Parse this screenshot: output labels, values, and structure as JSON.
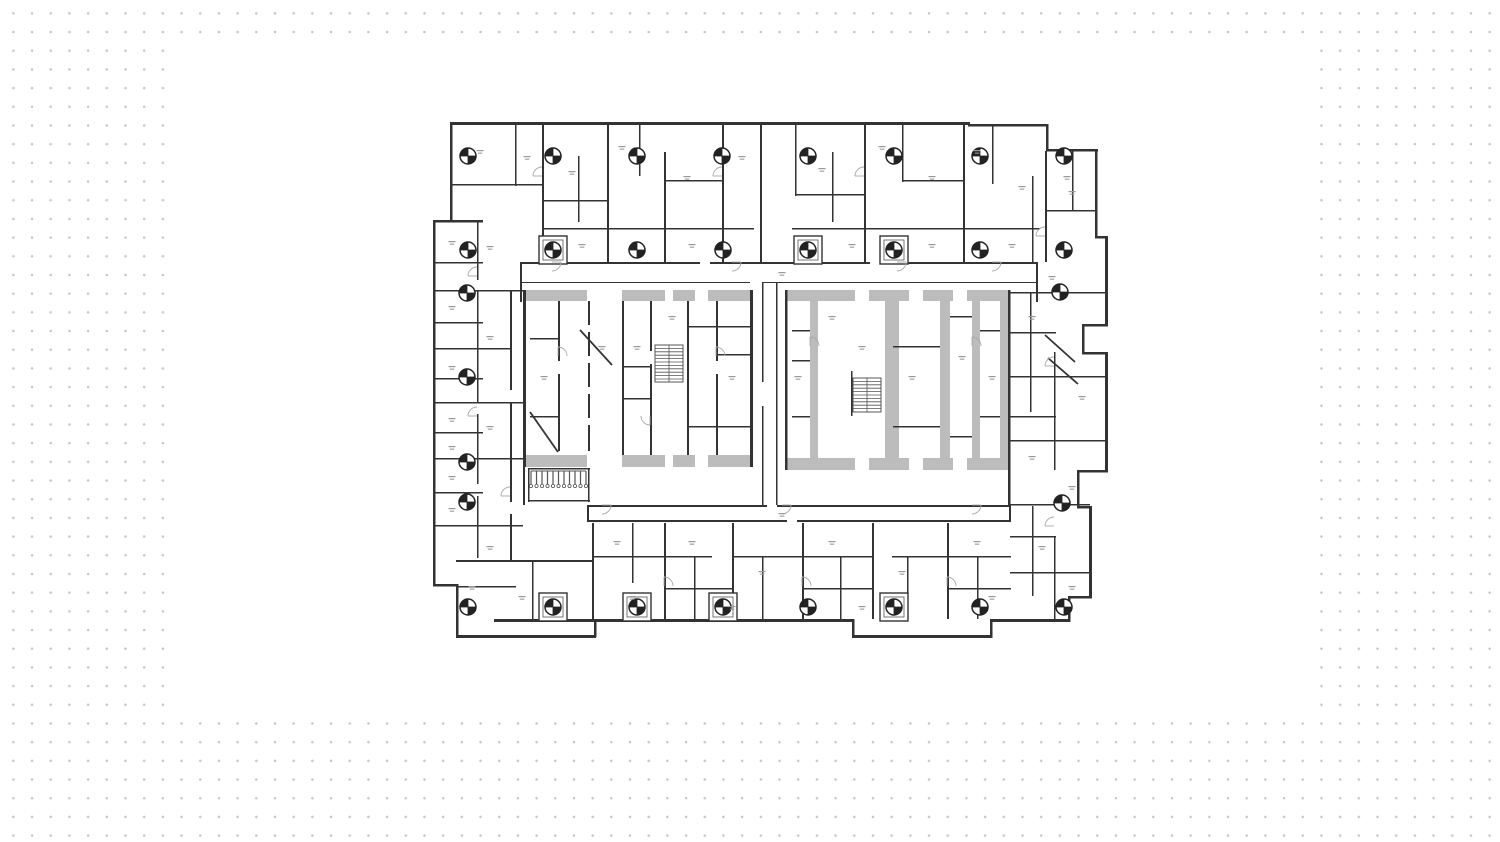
{
  "page": {
    "background": "#ffffff",
    "dot_color": "#c6c6ca",
    "dot_spacing_px": 18.7,
    "panel": {
      "x": 180,
      "y": 47,
      "width": 1140,
      "height": 663
    }
  },
  "floorplan": {
    "x": 432,
    "y": 116,
    "width": 676,
    "height": 524,
    "colors": {
      "wall": "#333333",
      "outer_wall": "#2a2a2a",
      "poche": "#bcbcbc",
      "arc": "#a8a8a8",
      "label": "#999999",
      "hatch": "#555555",
      "circle_stroke": "#222222"
    },
    "walls": [
      [
        18,
        6,
        520,
        3
      ],
      [
        536,
        8,
        80,
        2.5
      ],
      [
        614,
        8,
        2.5,
        27
      ],
      [
        614,
        33,
        52,
        2.5
      ],
      [
        663,
        33,
        2.5,
        89
      ],
      [
        663,
        120,
        13,
        2.5
      ],
      [
        673,
        120,
        3,
        90
      ],
      [
        650,
        208,
        26,
        2.5
      ],
      [
        650,
        208,
        2.5,
        30
      ],
      [
        650,
        236,
        26,
        2.5
      ],
      [
        673,
        236,
        3,
        120
      ],
      [
        645,
        354,
        31,
        2.5
      ],
      [
        645,
        354,
        2.5,
        38
      ],
      [
        645,
        390,
        15,
        2.5
      ],
      [
        657,
        390,
        3,
        92
      ],
      [
        636,
        480,
        24,
        2.5
      ],
      [
        636,
        480,
        2.5,
        26
      ],
      [
        560,
        503,
        78,
        3
      ],
      [
        558,
        503,
        2.5,
        19
      ],
      [
        420,
        519,
        140,
        3
      ],
      [
        420,
        503,
        2.5,
        19
      ],
      [
        62,
        503,
        360,
        3
      ],
      [
        162,
        503,
        2.5,
        18
      ],
      [
        24,
        519,
        140,
        3
      ],
      [
        24,
        468,
        2.5,
        54
      ],
      [
        1,
        468,
        25,
        2.5
      ],
      [
        1,
        104,
        2.5,
        366
      ],
      [
        1,
        104,
        50,
        2.5
      ],
      [
        18,
        6,
        2.5,
        100
      ],
      [
        83,
        6,
        1.6,
        64
      ],
      [
        110,
        6,
        2,
        140
      ],
      [
        146,
        40,
        1.6,
        66
      ],
      [
        175,
        6,
        2,
        140
      ],
      [
        207,
        6,
        1.6,
        54
      ],
      [
        232,
        36,
        2,
        110
      ],
      [
        290,
        6,
        2,
        140
      ],
      [
        328,
        6,
        2,
        140
      ],
      [
        363,
        6,
        1.6,
        74
      ],
      [
        400,
        36,
        1.6,
        70
      ],
      [
        432,
        6,
        2,
        140
      ],
      [
        470,
        6,
        1.6,
        60
      ],
      [
        531,
        8,
        2,
        138
      ],
      [
        560,
        8,
        1.6,
        60
      ],
      [
        613,
        35,
        2,
        111
      ],
      [
        640,
        35,
        1.6,
        60
      ],
      [
        18,
        68,
        92,
        1.6
      ],
      [
        110,
        84,
        65,
        1.6
      ],
      [
        232,
        64,
        58,
        1.6
      ],
      [
        363,
        78,
        69,
        1.6
      ],
      [
        470,
        64,
        61,
        1.6
      ],
      [
        613,
        94,
        51,
        1.6
      ],
      [
        110,
        112,
        212,
        1.6
      ],
      [
        360,
        112,
        248,
        1.6
      ],
      [
        88,
        146,
        180,
        2
      ],
      [
        278,
        146,
        160,
        2
      ],
      [
        448,
        146,
        158,
        2
      ],
      [
        88,
        166,
        230,
        1.2
      ],
      [
        330,
        166,
        276,
        1.2
      ],
      [
        88,
        146,
        2,
        40
      ],
      [
        604,
        146,
        2,
        40
      ],
      [
        91,
        174,
        3,
        177
      ],
      [
        318,
        174,
        3,
        177
      ],
      [
        126,
        185,
        2,
        60
      ],
      [
        126,
        258,
        2,
        77
      ],
      [
        156,
        185,
        2,
        24
      ],
      [
        156,
        216,
        2,
        24
      ],
      [
        156,
        247,
        2,
        24
      ],
      [
        156,
        278,
        2,
        24
      ],
      [
        156,
        309,
        2,
        26
      ],
      [
        190,
        185,
        2,
        154
      ],
      [
        218,
        185,
        2,
        50
      ],
      [
        218,
        248,
        2,
        91
      ],
      [
        255,
        185,
        2,
        154
      ],
      [
        284,
        185,
        2,
        60
      ],
      [
        284,
        258,
        2,
        81
      ],
      [
        98,
        222,
        28,
        1.6
      ],
      [
        98,
        300,
        28,
        1.6
      ],
      [
        255,
        210,
        63,
        1.6
      ],
      [
        255,
        310,
        63,
        1.6
      ],
      [
        190,
        250,
        28,
        1.6
      ],
      [
        190,
        282,
        28,
        1.6
      ],
      [
        284,
        238,
        34,
        1.6
      ],
      [
        96,
        352,
        62,
        1.6
      ],
      [
        96,
        352,
        1.6,
        34
      ],
      [
        156,
        352,
        1.6,
        34
      ],
      [
        96,
        384,
        62,
        1.6
      ],
      [
        353,
        174,
        2.5,
        180
      ],
      [
        576,
        174,
        2.5,
        180
      ],
      [
        360,
        214,
        18,
        1.6
      ],
      [
        360,
        244,
        18,
        1.6
      ],
      [
        360,
        300,
        18,
        1.6
      ],
      [
        461,
        230,
        47,
        1.6
      ],
      [
        461,
        310,
        47,
        1.6
      ],
      [
        518,
        200,
        22,
        1.6
      ],
      [
        518,
        320,
        22,
        1.6
      ],
      [
        548,
        214,
        20,
        1.6
      ],
      [
        548,
        300,
        20,
        1.6
      ],
      [
        419,
        255,
        1.6,
        45
      ],
      [
        576,
        354,
        2.5,
        37
      ],
      [
        330,
        166,
        1.6,
        100
      ],
      [
        330,
        290,
        1.6,
        99
      ],
      [
        344,
        166,
        1.6,
        223
      ],
      [
        155,
        389,
        180,
        2
      ],
      [
        345,
        389,
        234,
        2
      ],
      [
        155,
        404,
        200,
        2
      ],
      [
        365,
        404,
        214,
        2
      ],
      [
        155,
        389,
        2,
        17
      ],
      [
        577,
        389,
        2,
        17
      ],
      [
        1,
        146,
        50,
        1.6
      ],
      [
        1,
        174,
        90,
        1.6
      ],
      [
        1,
        206,
        50,
        1.6
      ],
      [
        1,
        232,
        77,
        1.6
      ],
      [
        1,
        262,
        50,
        1.6
      ],
      [
        1,
        286,
        90,
        1.6
      ],
      [
        1,
        316,
        50,
        1.6
      ],
      [
        1,
        342,
        90,
        1.6
      ],
      [
        1,
        376,
        50,
        1.6
      ],
      [
        1,
        409,
        90,
        1.6
      ],
      [
        24,
        444,
        138,
        2
      ],
      [
        45,
        104,
        1.6,
        60
      ],
      [
        45,
        174,
        1.6,
        112
      ],
      [
        45,
        298,
        1.6,
        70
      ],
      [
        45,
        380,
        1.6,
        62
      ],
      [
        78,
        174,
        2,
        100
      ],
      [
        78,
        286,
        2,
        100
      ],
      [
        78,
        398,
        2,
        46
      ],
      [
        91,
        351,
        2,
        38
      ],
      [
        24,
        470,
        60,
        1.6
      ],
      [
        100,
        444,
        1.6,
        60
      ],
      [
        160,
        407,
        2,
        96
      ],
      [
        200,
        407,
        1.6,
        60
      ],
      [
        232,
        407,
        2,
        96
      ],
      [
        262,
        440,
        1.6,
        63
      ],
      [
        300,
        407,
        2,
        96
      ],
      [
        330,
        440,
        1.6,
        63
      ],
      [
        370,
        407,
        2,
        96
      ],
      [
        408,
        440,
        1.6,
        63
      ],
      [
        440,
        407,
        2,
        96
      ],
      [
        475,
        440,
        1.6,
        63
      ],
      [
        515,
        407,
        2,
        96
      ],
      [
        545,
        440,
        1.6,
        63
      ],
      [
        160,
        440,
        120,
        1.6
      ],
      [
        300,
        440,
        140,
        1.6
      ],
      [
        460,
        440,
        119,
        1.6
      ],
      [
        232,
        472,
        68,
        1.6
      ],
      [
        370,
        472,
        70,
        1.6
      ],
      [
        515,
        472,
        64,
        1.6
      ],
      [
        600,
        60,
        1.6,
        86
      ],
      [
        598,
        176,
        1.6,
        120
      ],
      [
        622,
        236,
        1.6,
        118
      ],
      [
        578,
        176,
        98,
        1.6
      ],
      [
        578,
        216,
        46,
        1.6
      ],
      [
        578,
        260,
        98,
        1.6
      ],
      [
        578,
        300,
        46,
        1.6
      ],
      [
        578,
        324,
        98,
        1.6
      ],
      [
        578,
        388,
        80,
        1.6
      ],
      [
        578,
        420,
        46,
        1.6
      ],
      [
        578,
        456,
        80,
        1.6
      ],
      [
        600,
        390,
        1.6,
        90
      ],
      [
        622,
        420,
        1.6,
        83
      ]
    ],
    "poche": [
      [
        93,
        174,
        62,
        11
      ],
      [
        190,
        174,
        43,
        11
      ],
      [
        241,
        174,
        22,
        11
      ],
      [
        276,
        174,
        42,
        11
      ],
      [
        93,
        339,
        62,
        12
      ],
      [
        190,
        339,
        43,
        12
      ],
      [
        241,
        339,
        22,
        12
      ],
      [
        276,
        339,
        42,
        12
      ],
      [
        355,
        174,
        68,
        11
      ],
      [
        437,
        174,
        40,
        11
      ],
      [
        491,
        174,
        30,
        11
      ],
      [
        535,
        174,
        41,
        11
      ],
      [
        355,
        342,
        68,
        12
      ],
      [
        437,
        342,
        40,
        12
      ],
      [
        491,
        342,
        30,
        12
      ],
      [
        535,
        342,
        41,
        12
      ],
      [
        378,
        185,
        8,
        157
      ],
      [
        453,
        185,
        14,
        157
      ],
      [
        508,
        185,
        10,
        157
      ],
      [
        540,
        185,
        8,
        157
      ],
      [
        568,
        185,
        8,
        157
      ]
    ],
    "columns": {
      "r": 8,
      "centers": [
        [
          36,
          40
        ],
        [
          121,
          40
        ],
        [
          205,
          40
        ],
        [
          290,
          40
        ],
        [
          376,
          40
        ],
        [
          462,
          40
        ],
        [
          548,
          40
        ],
        [
          632,
          40
        ],
        [
          36,
          134
        ],
        [
          121,
          134
        ],
        [
          205,
          134
        ],
        [
          291,
          134
        ],
        [
          376,
          134
        ],
        [
          462,
          134
        ],
        [
          548,
          134
        ],
        [
          632,
          134
        ],
        [
          35,
          177
        ],
        [
          35,
          261
        ],
        [
          35,
          346
        ],
        [
          35,
          386
        ],
        [
          36,
          491
        ],
        [
          121,
          491
        ],
        [
          205,
          491
        ],
        [
          291,
          491
        ],
        [
          376,
          491
        ],
        [
          462,
          491
        ],
        [
          548,
          491
        ],
        [
          632,
          491
        ],
        [
          628,
          176
        ],
        [
          630,
          387
        ]
      ]
    },
    "shaft_boxes": [
      [
        107,
        477
      ],
      [
        191,
        477
      ],
      [
        277,
        477
      ],
      [
        448,
        477
      ],
      [
        107,
        120
      ],
      [
        362,
        120
      ],
      [
        448,
        120
      ]
    ],
    "stairs": [
      {
        "x": 223,
        "y": 229,
        "w": 28,
        "h": 37,
        "step": 3.4
      },
      {
        "x": 421,
        "y": 262,
        "w": 28,
        "h": 34,
        "step": 3.4
      }
    ],
    "comb": {
      "x": 99,
      "y": 355,
      "w": 55,
      "h": 13,
      "step": 5.5
    },
    "diagonals": [
      [
        98,
        296,
        126,
        336
      ],
      [
        148,
        214,
        180,
        249
      ],
      [
        613,
        219,
        643,
        246
      ],
      [
        616,
        242,
        646,
        268
      ]
    ],
    "door_arcs": [
      [
        120,
        146,
        9,
        1
      ],
      [
        300,
        146,
        9,
        1
      ],
      [
        465,
        146,
        9,
        1
      ],
      [
        560,
        146,
        9,
        1
      ],
      [
        170,
        389,
        9,
        1
      ],
      [
        350,
        389,
        9,
        1
      ],
      [
        540,
        389,
        9,
        1
      ],
      [
        126,
        240,
        9,
        0
      ],
      [
        284,
        240,
        9,
        0
      ],
      [
        218,
        300,
        9,
        2
      ],
      [
        378,
        230,
        9,
        0
      ],
      [
        540,
        230,
        9,
        0
      ],
      [
        45,
        160,
        9,
        3
      ],
      [
        45,
        300,
        9,
        3
      ],
      [
        78,
        380,
        9,
        3
      ],
      [
        232,
        470,
        9,
        0
      ],
      [
        370,
        470,
        9,
        0
      ],
      [
        515,
        470,
        9,
        0
      ],
      [
        622,
        250,
        9,
        3
      ],
      [
        622,
        410,
        9,
        3
      ],
      [
        110,
        60,
        9,
        3
      ],
      [
        290,
        60,
        9,
        3
      ],
      [
        432,
        60,
        9,
        3
      ],
      [
        613,
        120,
        9,
        3
      ]
    ],
    "label_marks": [
      [
        48,
        34
      ],
      [
        95,
        40
      ],
      [
        140,
        55
      ],
      [
        190,
        30
      ],
      [
        255,
        60
      ],
      [
        310,
        40
      ],
      [
        390,
        52
      ],
      [
        450,
        30
      ],
      [
        500,
        60
      ],
      [
        545,
        34
      ],
      [
        590,
        70
      ],
      [
        635,
        60
      ],
      [
        20,
        125
      ],
      [
        20,
        190
      ],
      [
        20,
        250
      ],
      [
        20,
        302
      ],
      [
        20,
        330
      ],
      [
        20,
        360
      ],
      [
        20,
        392
      ],
      [
        58,
        130
      ],
      [
        58,
        220
      ],
      [
        58,
        310
      ],
      [
        58,
        430
      ],
      [
        40,
        470
      ],
      [
        90,
        480
      ],
      [
        112,
        260
      ],
      [
        170,
        230
      ],
      [
        205,
        230
      ],
      [
        240,
        200
      ],
      [
        300,
        260
      ],
      [
        366,
        260
      ],
      [
        400,
        200
      ],
      [
        430,
        230
      ],
      [
        480,
        260
      ],
      [
        530,
        240
      ],
      [
        560,
        260
      ],
      [
        350,
        156
      ],
      [
        350,
        397
      ],
      [
        185,
        425
      ],
      [
        260,
        425
      ],
      [
        330,
        455
      ],
      [
        400,
        425
      ],
      [
        470,
        455
      ],
      [
        545,
        425
      ],
      [
        200,
        480
      ],
      [
        300,
        490
      ],
      [
        430,
        490
      ],
      [
        560,
        480
      ],
      [
        640,
        75
      ],
      [
        620,
        160
      ],
      [
        600,
        200
      ],
      [
        650,
        280
      ],
      [
        600,
        340
      ],
      [
        640,
        370
      ],
      [
        610,
        430
      ],
      [
        640,
        470
      ],
      [
        150,
        128
      ],
      [
        260,
        128
      ],
      [
        420,
        128
      ],
      [
        500,
        128
      ],
      [
        580,
        128
      ]
    ]
  }
}
